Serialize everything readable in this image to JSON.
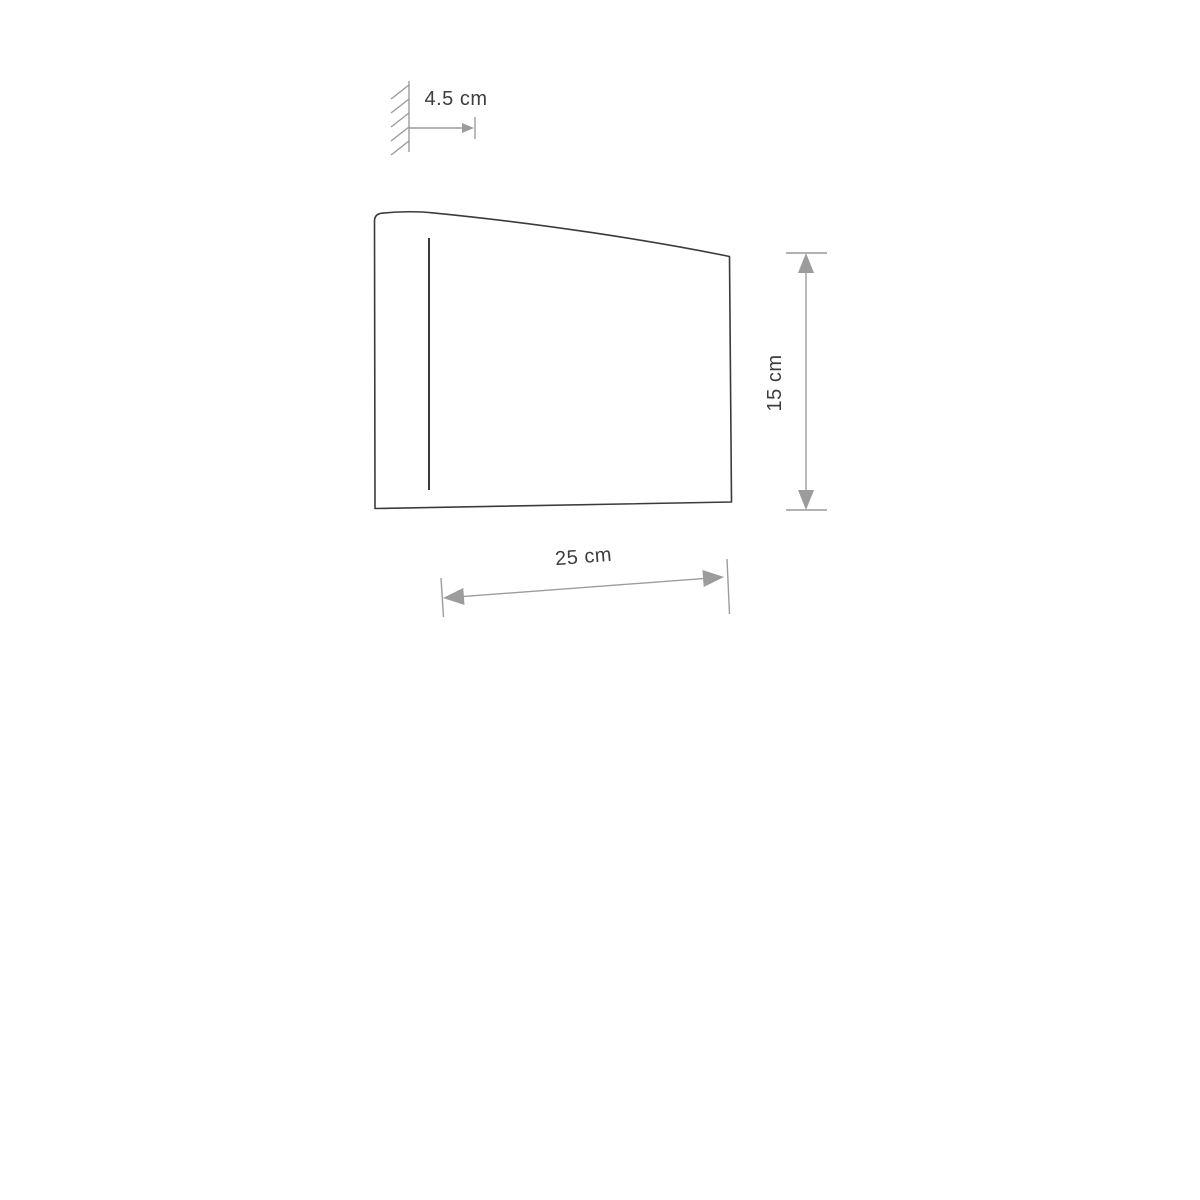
{
  "diagram": {
    "kind": "wall-lamp-dimension-drawing",
    "background": "#ffffff",
    "colors": {
      "outline": "#3b3b3b",
      "dimension_line": "#9c9c9c",
      "end_cap": "#b3b3b3",
      "label_text": "#3d3d3d",
      "wall_symbol": "#9c9c9c"
    },
    "labels": {
      "depth": "4.5 cm",
      "height": "15 cm",
      "width": "25 cm"
    }
  }
}
